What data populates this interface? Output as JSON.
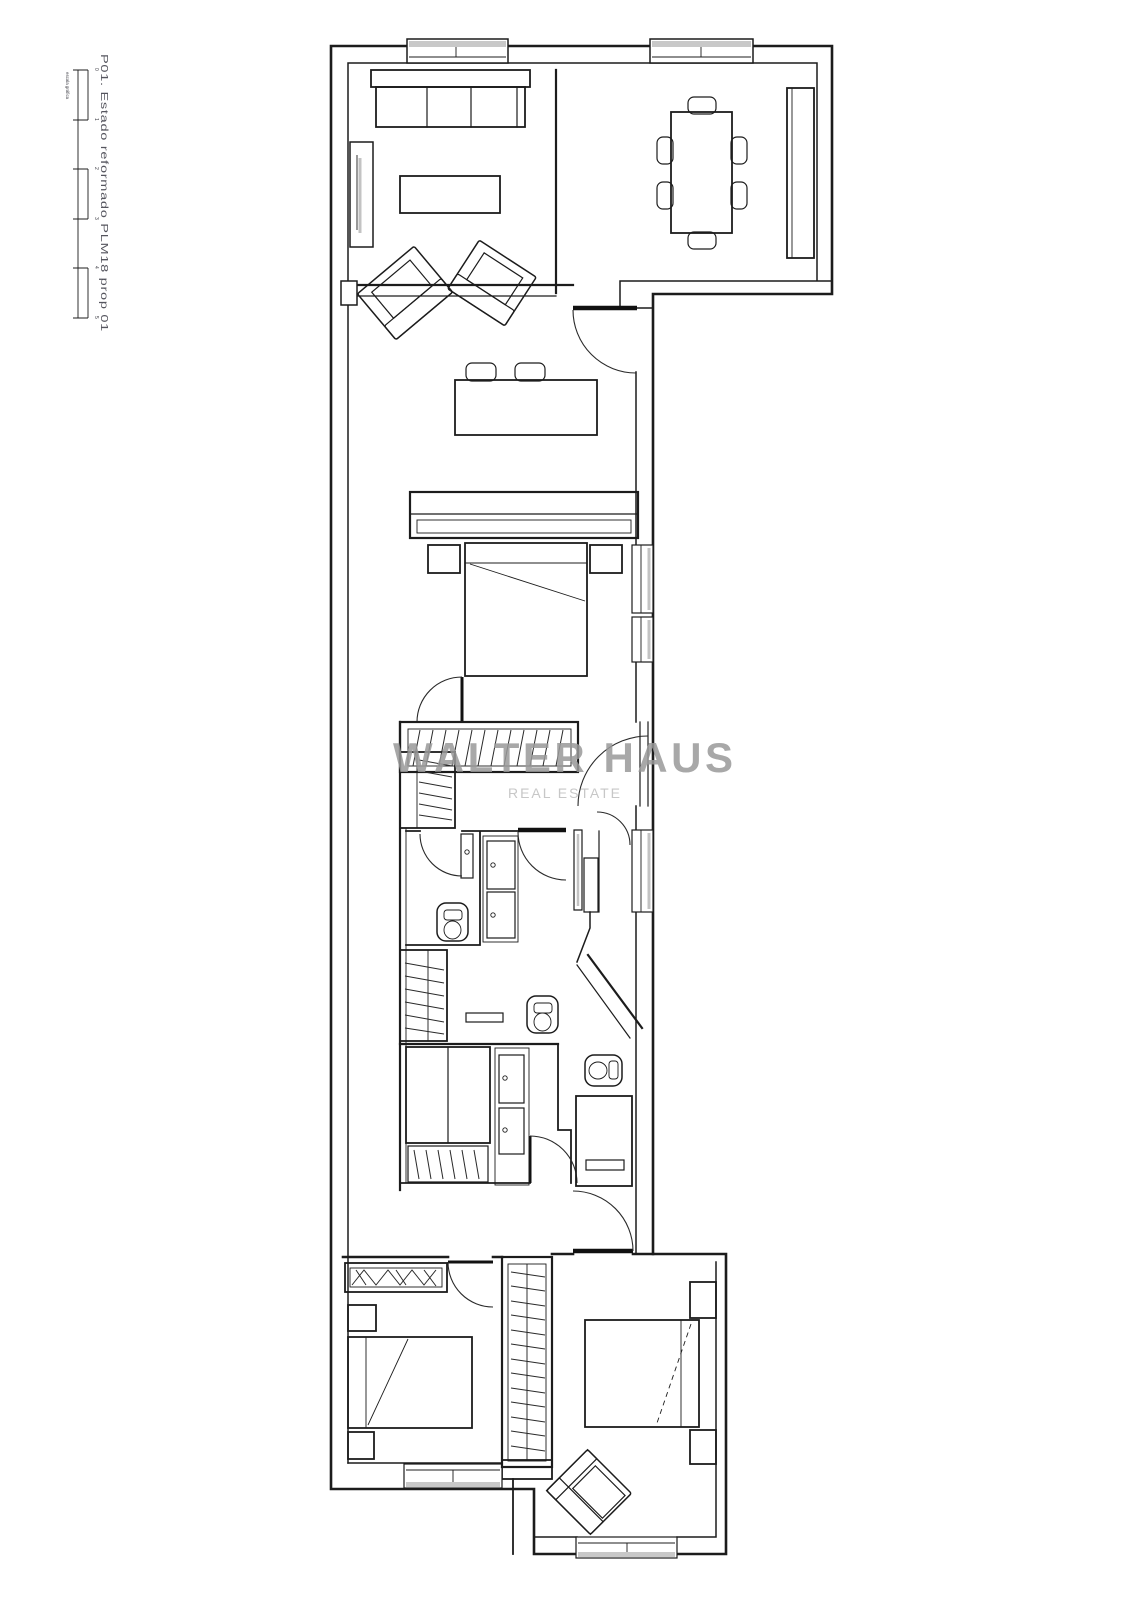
{
  "page": {
    "background": "#ffffff"
  },
  "sidebar": {
    "title": "P01. Estado reformado PLM18 prop 01",
    "scale": {
      "caption": "escala gráfica",
      "labels": [
        "0",
        "1",
        "2",
        "3",
        "4",
        "5"
      ]
    }
  },
  "watermark": {
    "line1": "WALTER HAUS",
    "line2": "REAL ESTATE"
  },
  "colors": {
    "line": "#1c1c1c",
    "window_shadow": "#c3c3c3",
    "watermark": "#9a9a9a",
    "watermark_sub": "#c2c2c2",
    "title_text": "#55555e"
  }
}
